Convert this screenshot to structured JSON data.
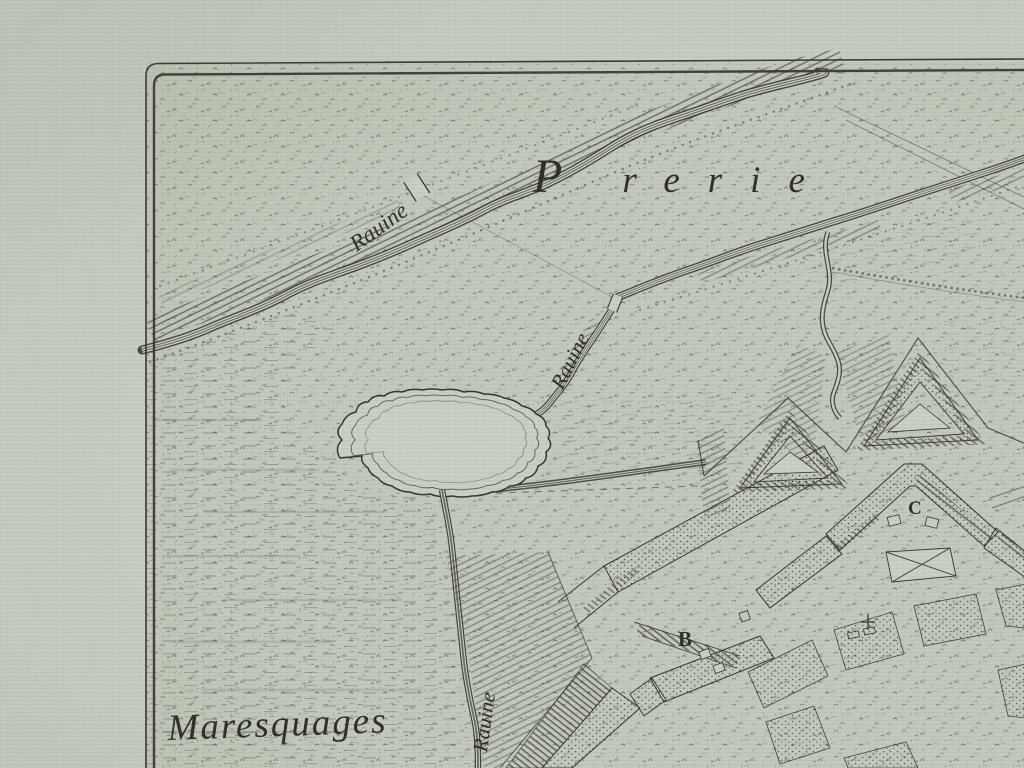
{
  "map": {
    "colors": {
      "paper": "#cbd2c6",
      "ink": "#34332c"
    },
    "region_labels": {
      "prerie_initial": "P",
      "prerie_rest": "rerie",
      "marsh": "Maresquages"
    },
    "river_labels": {
      "upper": "Rauine",
      "middle": "Rauine",
      "lower": "Rauine"
    },
    "fort_markers": {
      "bastion_b": "B",
      "bastion_c": "C"
    }
  }
}
